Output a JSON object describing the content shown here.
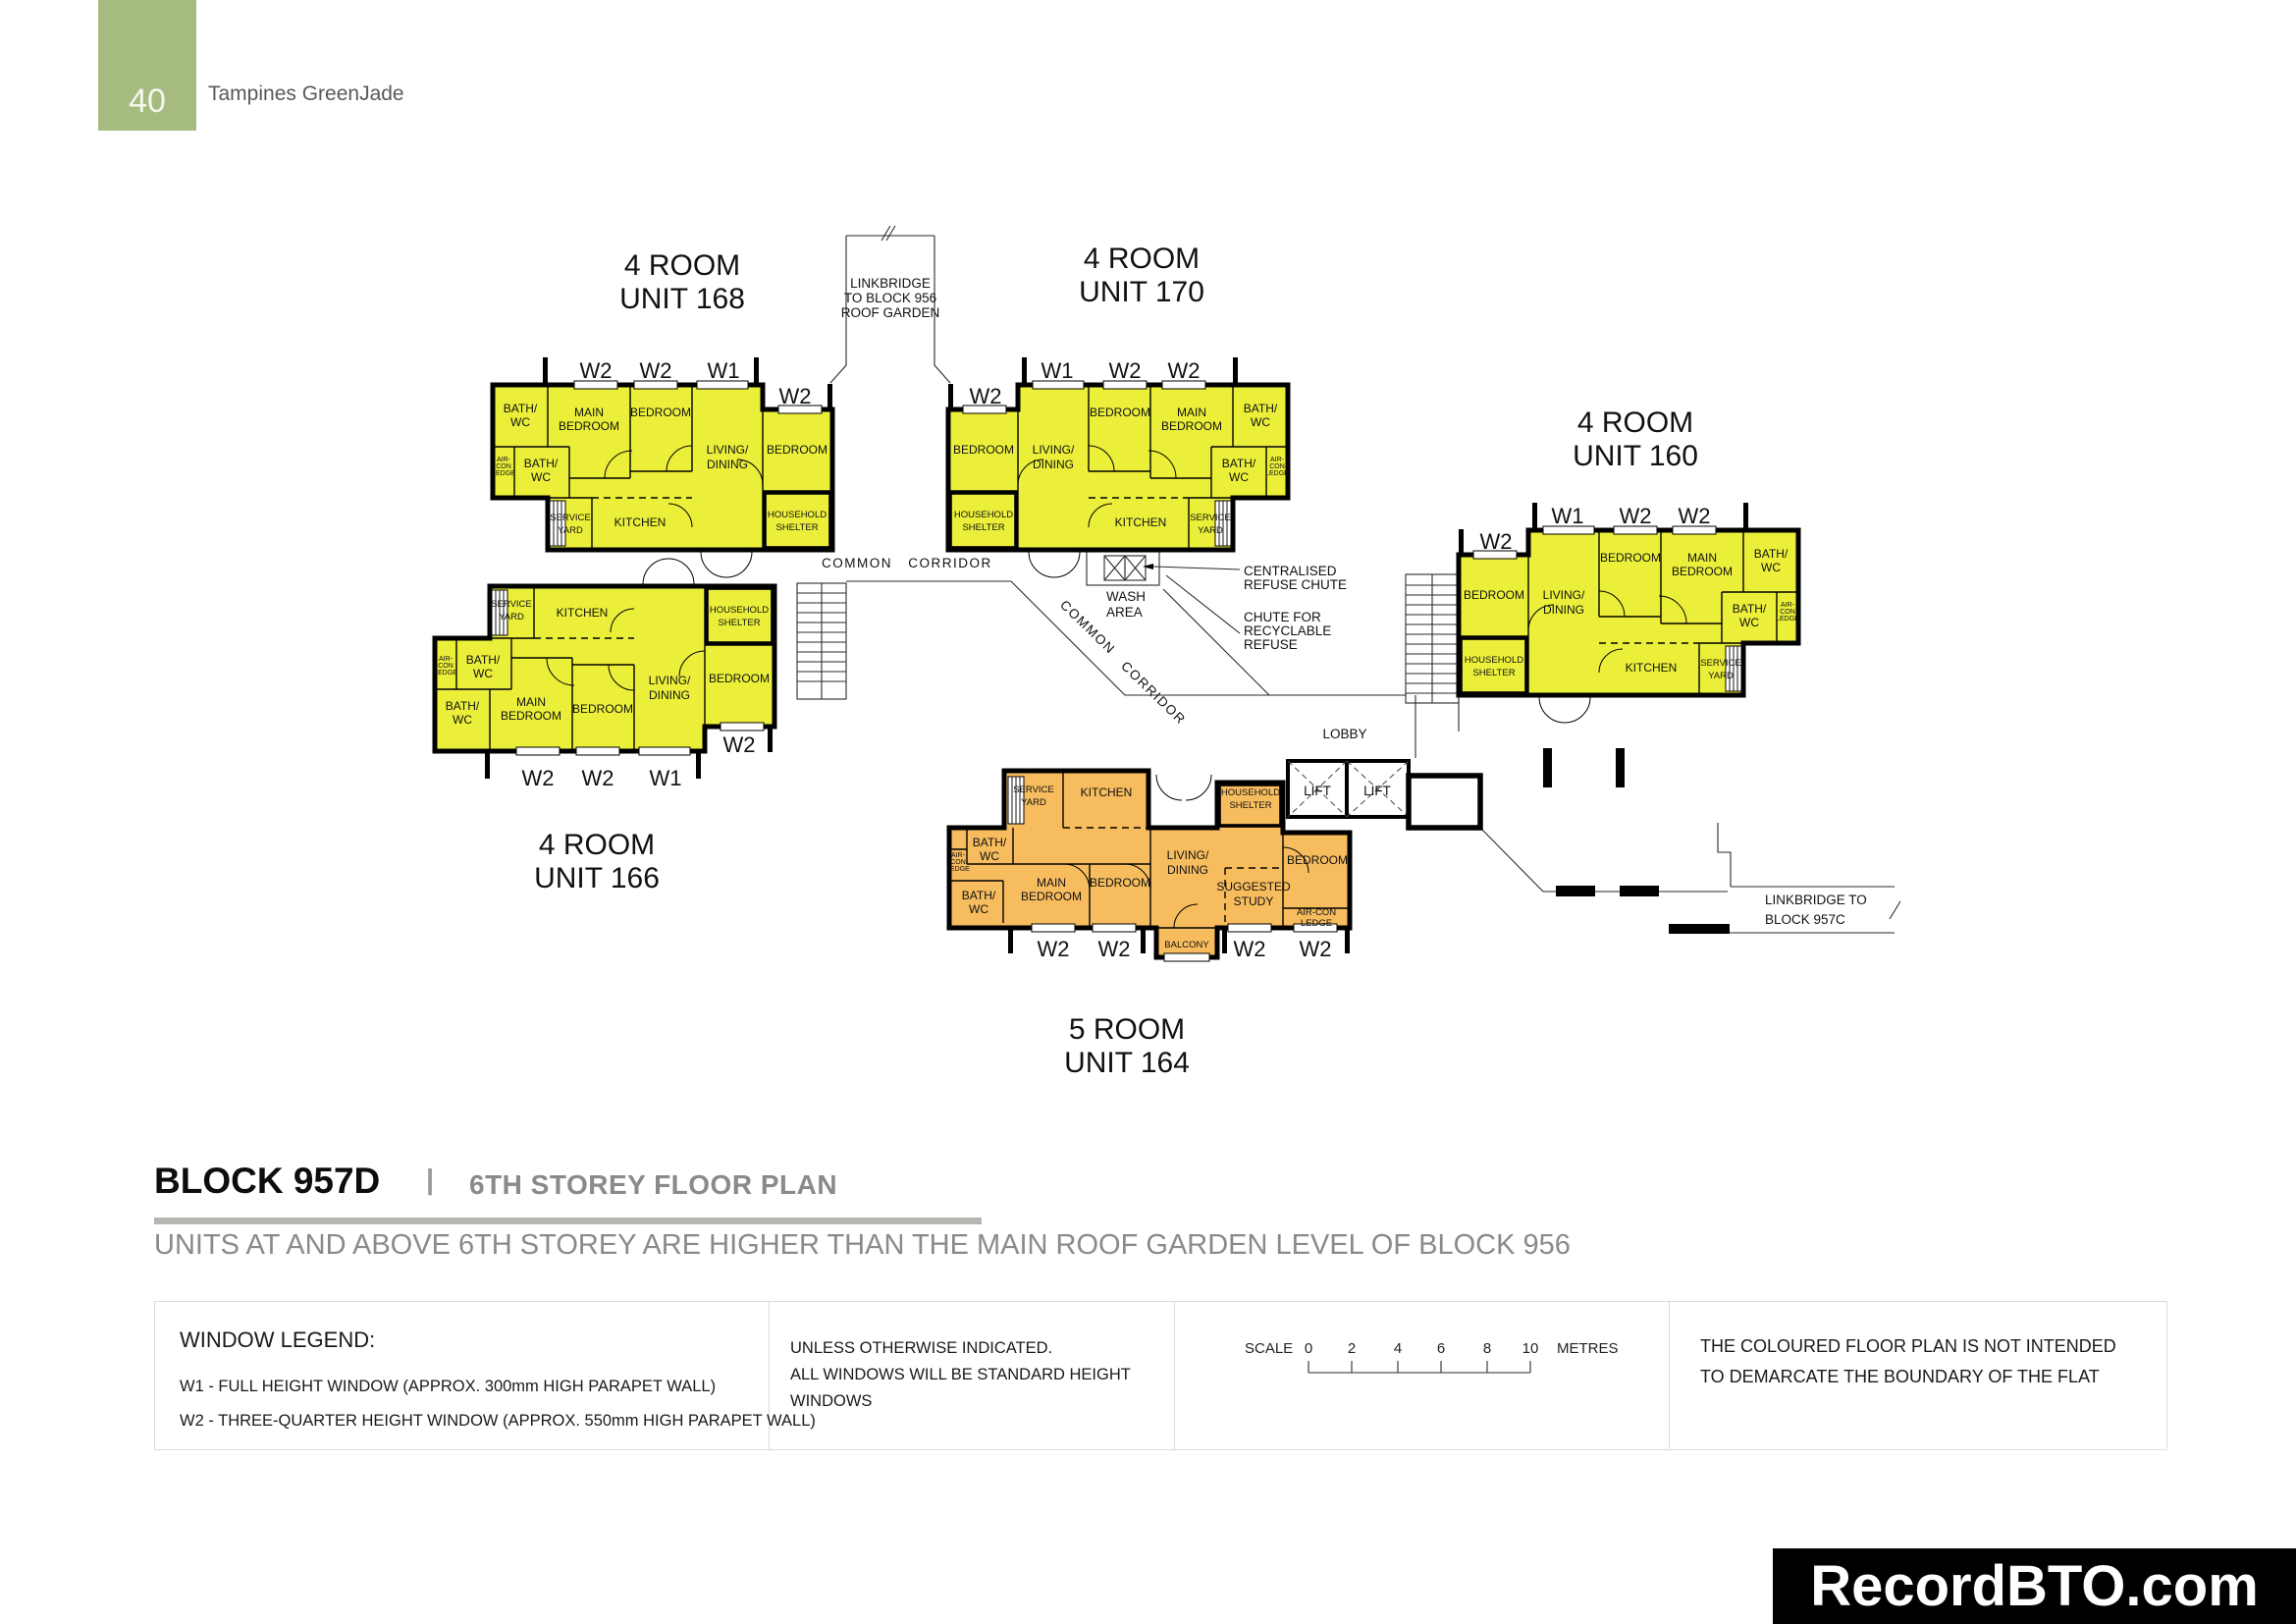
{
  "page": {
    "number": "40",
    "project": "Tampines GreenJade"
  },
  "heading": {
    "block": "BLOCK 957D",
    "divider": "|",
    "title": "6TH STOREY FLOOR PLAN",
    "note": "UNITS AT AND ABOVE 6TH STOREY ARE HIGHER THAN THE MAIN ROOF GARDEN LEVEL OF BLOCK 956"
  },
  "legend": {
    "window_legend_title": "WINDOW LEGEND:",
    "w1_desc": "W1 - FULL HEIGHT WINDOW (APPROX. 300mm HIGH PARAPET WALL)",
    "w2_desc": "W2 - THREE-QUARTER HEIGHT WINDOW (APPROX. 550mm HIGH PARAPET WALL)",
    "windows_note_1": "UNLESS OTHERWISE INDICATED.",
    "windows_note_2": "ALL WINDOWS WILL BE STANDARD HEIGHT",
    "windows_note_3": "WINDOWS",
    "scale_label": "SCALE",
    "scale_ticks": [
      "0",
      "2",
      "4",
      "6",
      "8",
      "10"
    ],
    "scale_unit": "METRES",
    "boundary_note_1": "THE COLOURED FLOOR PLAN IS NOT INTENDED",
    "boundary_note_2": "TO DEMARCATE THE BOUNDARY OF THE FLAT"
  },
  "watermark": "RecordBTO.com",
  "colors": {
    "four_room": "#ebef3a",
    "five_room": "#f6bc5e",
    "page_tab": "#a6bb80"
  },
  "plan": {
    "annotations": {
      "linkbridge956_1": "LINKBRIDGE",
      "linkbridge956_2": "TO BLOCK 956",
      "linkbridge956_3": "ROOF GARDEN",
      "common": "COMMON",
      "corridor": "CORRIDOR",
      "wash_1": "WASH",
      "wash_2": "AREA",
      "refuse_1": "CENTRALISED",
      "refuse_2": "REFUSE CHUTE",
      "recycle_1": "CHUTE FOR",
      "recycle_2": "RECYCLABLE",
      "recycle_3": "REFUSE",
      "lobby": "LOBBY",
      "lift": "LIFT",
      "linkbridge957c_1": "LINKBRIDGE TO",
      "linkbridge957c_2": "BLOCK 957C"
    },
    "rooms": {
      "main_1": "MAIN",
      "main_2": "BEDROOM",
      "bedroom": "BEDROOM",
      "living_1": "LIVING/",
      "living_2": "DINING",
      "bath_1": "BATH/",
      "bath_2": "WC",
      "kitchen": "KITCHEN",
      "service_1": "SERVICE",
      "service_2": "YARD",
      "shelter_1": "HOUSEHOLD",
      "shelter_2": "SHELTER",
      "aircon_1": "AIR-",
      "aircon_2": "CON",
      "aircon_3": "LEDGE",
      "airconf_1": "AIR-CON",
      "airconf_2": "LEDGE",
      "study_1": "SUGGESTED",
      "study_2": "STUDY",
      "balcony": "BALCONY",
      "w1": "W1",
      "w2": "W2"
    },
    "units": {
      "u168": {
        "t1": "4 ROOM",
        "t2": "UNIT 168"
      },
      "u170": {
        "t1": "4 ROOM",
        "t2": "UNIT 170"
      },
      "u160": {
        "t1": "4 ROOM",
        "t2": "UNIT 160"
      },
      "u166": {
        "t1": "4 ROOM",
        "t2": "UNIT 166"
      },
      "u164": {
        "t1": "5 ROOM",
        "t2": "UNIT 164"
      }
    }
  }
}
